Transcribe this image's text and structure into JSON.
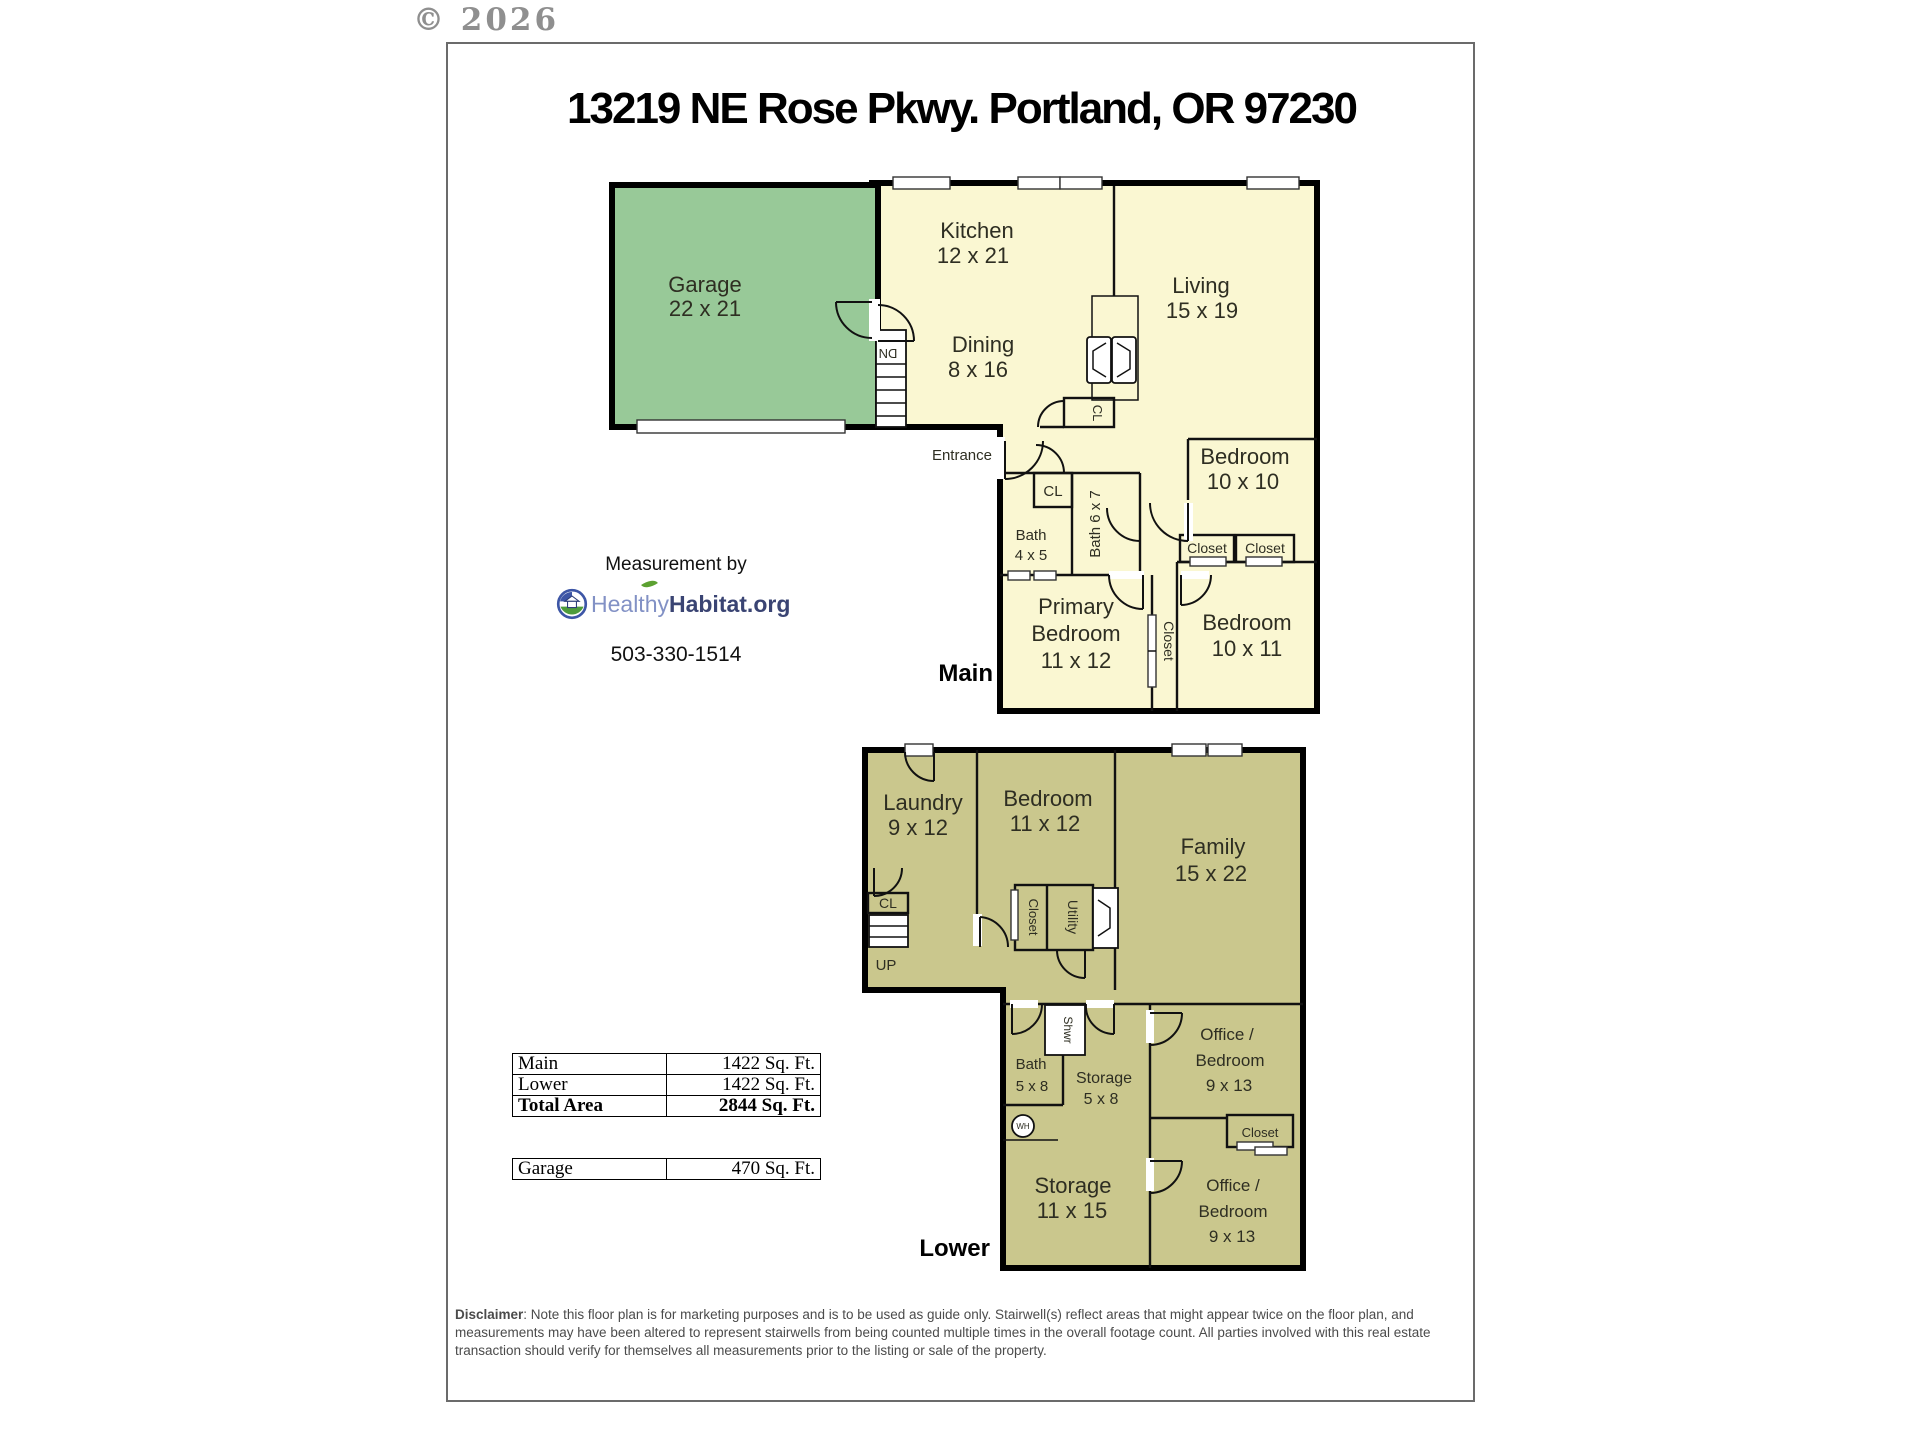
{
  "copyright": "© 2026",
  "title": "13219 NE Rose Pkwy. Portland, OR 97230",
  "measurement": {
    "caption": "Measurement by",
    "brand_first": "Healthy",
    "brand_second": "Habitat.org",
    "phone": "503-330-1514"
  },
  "main_floor": {
    "level_label": "Main",
    "entrance": "Entrance",
    "stairs": "DN",
    "garage": {
      "name": "Garage",
      "dim": "22 x 21"
    },
    "kitchen": {
      "name": "Kitchen",
      "dim": "12 x 21"
    },
    "dining": {
      "name": "Dining",
      "dim": "8 x 16"
    },
    "living": {
      "name": "Living",
      "dim": "15 x 19"
    },
    "bedroom1": {
      "name": "Bedroom",
      "dim": "10 x 10"
    },
    "bedroom2": {
      "name": "Bedroom",
      "dim": "10 x 11"
    },
    "primary": {
      "line1": "Primary",
      "line2": "Bedroom",
      "dim": "11 x 12"
    },
    "bath1": {
      "name": "Bath",
      "dim": "4 x 5"
    },
    "bath2": {
      "label": "Bath 6 x 7"
    },
    "closet_entry": "CL",
    "closet_fireplace": "CL",
    "closet_a": "Closet",
    "closet_b": "Closet",
    "closet_corridor": "Closet"
  },
  "lower_floor": {
    "level_label": "Lower",
    "stairs": "UP",
    "closet_entry": "CL",
    "laundry": {
      "name": "Laundry",
      "dim": "9 x 12"
    },
    "bedroom": {
      "name": "Bedroom",
      "dim": "11 x 12"
    },
    "family": {
      "name": "Family",
      "dim": "15 x 22"
    },
    "closet_v": "Closet",
    "utility": "Utility",
    "bath": {
      "name": "Bath",
      "dim": "5 x 8"
    },
    "shower": "Shwr",
    "water_heater": "WH",
    "storage1": {
      "name": "Storage",
      "dim": "5 x 8"
    },
    "storage2": {
      "name": "Storage",
      "dim": "11 x 15"
    },
    "office1": {
      "line1": "Office /",
      "line2": "Bedroom",
      "dim": "9 x 13"
    },
    "office2": {
      "line1": "Office /",
      "line2": "Bedroom",
      "dim": "9 x 13"
    },
    "closet": "Closet"
  },
  "area_table": {
    "rows": [
      {
        "label": "Main",
        "value": "1422 Sq. Ft."
      },
      {
        "label": "Lower",
        "value": "1422 Sq. Ft."
      },
      {
        "label": "Total Area",
        "value": "2844 Sq. Ft."
      }
    ]
  },
  "garage_table": {
    "rows": [
      {
        "label": "Garage",
        "value": "470 Sq. Ft."
      }
    ]
  },
  "disclaimer": {
    "label": "Disclaimer",
    "text": ": Note this floor plan is for marketing purposes and is to be used as guide only.  Stairwell(s) reflect areas that might appear twice on the floor plan, and measurements may have been altered to represent stairwells from being counted multiple times in the overall footage count.  All parties involved with this real estate transaction should verify for themselves all measurements prior to the listing or sale of the property."
  },
  "colors": {
    "main_fill": "#FAF7D2",
    "garage_fill": "#98C998",
    "lower_fill": "#CAC78D",
    "wall": "#000000",
    "brand_light": "#8291C5",
    "brand_dark": "#3A4473",
    "leaf_green": "#5CA131"
  }
}
